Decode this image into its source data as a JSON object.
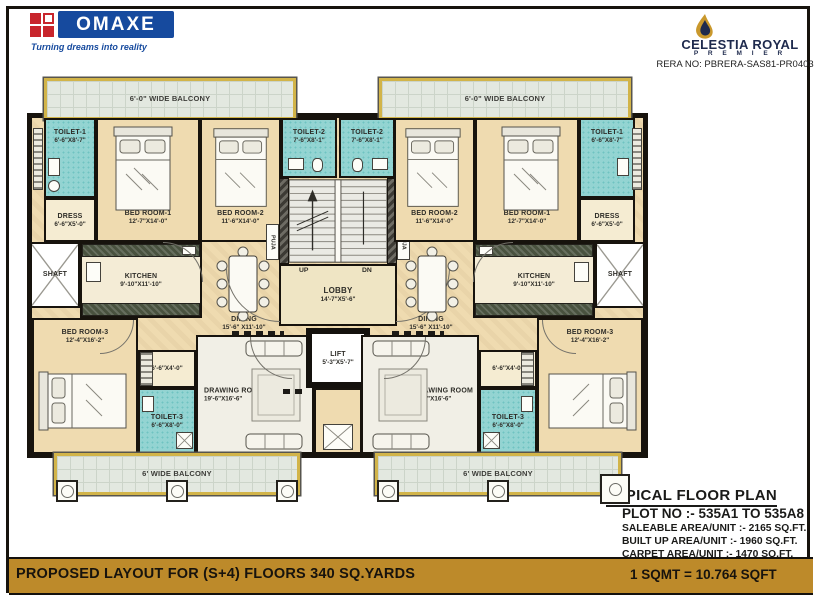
{
  "header": {
    "brand": {
      "name": "OMAXE",
      "tagline": "Turning dreams into reality"
    },
    "project": {
      "name": "CELESTIA ROYAL",
      "sub": "P R E M I E R",
      "rera": "RERA NO: PBRERA-SAS81-PR0403"
    }
  },
  "plan": {
    "balcony_top": "6'-0\" WIDE BALCONY",
    "balcony_bottom": "6' WIDE BALCONY",
    "rooms": {
      "toilet1": {
        "name": "TOILET-1",
        "dims": "6'-6\"X8'-7\""
      },
      "toilet2": {
        "name": "TOILET-2",
        "dims": "7'-6\"X8'-1\""
      },
      "toilet3": {
        "name": "TOILET-3",
        "dims": "6'-6\"X8'-0\""
      },
      "dress": {
        "name": "DRESS",
        "dims": "6'-6\"X5'-0\""
      },
      "bed1": {
        "name": "BED ROOM-1",
        "dims": "12'-7\"X14'-0\""
      },
      "bed2": {
        "name": "BED ROOM-2",
        "dims": "11'-6\"X14'-0\""
      },
      "bed3": {
        "name": "BED ROOM-3",
        "dims": "12'-4\"X16'-2\""
      },
      "kitchen": {
        "name": "KITCHEN",
        "dims": "9'-10\"X11'-10\""
      },
      "dining": {
        "name": "DINING",
        "dims": "15'-6\" X11'-10\""
      },
      "drawing": {
        "name": "DRAWING ROOM",
        "dims": "19'-6\"X16'-6\""
      },
      "lobby": {
        "name": "LOBBY",
        "dims": "14'-7\"X5'-6\""
      },
      "lift": {
        "name": "LIFT",
        "dims": "5'-3\"X5'-7\""
      },
      "closet_dims": "6'-6''X4'-0''",
      "shaft": "SHAFT",
      "puja": "PUJA",
      "up": "UP",
      "dn": "DN"
    }
  },
  "info": {
    "title": "TYPICAL FLOOR PLAN",
    "plot": "PLOT NO :- 535A1 TO 535A8",
    "areas": [
      "SALEABLE AREA/UNIT :- 2165 SQ.FT.",
      "BUILT UP AREA/UNIT  :- 1960 SQ.FT.",
      "CARPET AREA/UNIT   :-  1470 SQ.FT."
    ]
  },
  "footer": {
    "left": "PROPOSED LAYOUT FOR (S+4) FLOORS 340 SQ.YARDS",
    "right": "1 SQMT = 10.764 SQFT"
  },
  "colors": {
    "brand_blue": "#164a9e",
    "brand_red": "#c8252c",
    "project_navy": "#1e2a4d",
    "gold_bar": "#bd8a2a",
    "balcony_trim": "#d2b449",
    "toilet_teal": "#93d4d2",
    "room_tan": "#efdbb0",
    "wall": "#17130d"
  }
}
